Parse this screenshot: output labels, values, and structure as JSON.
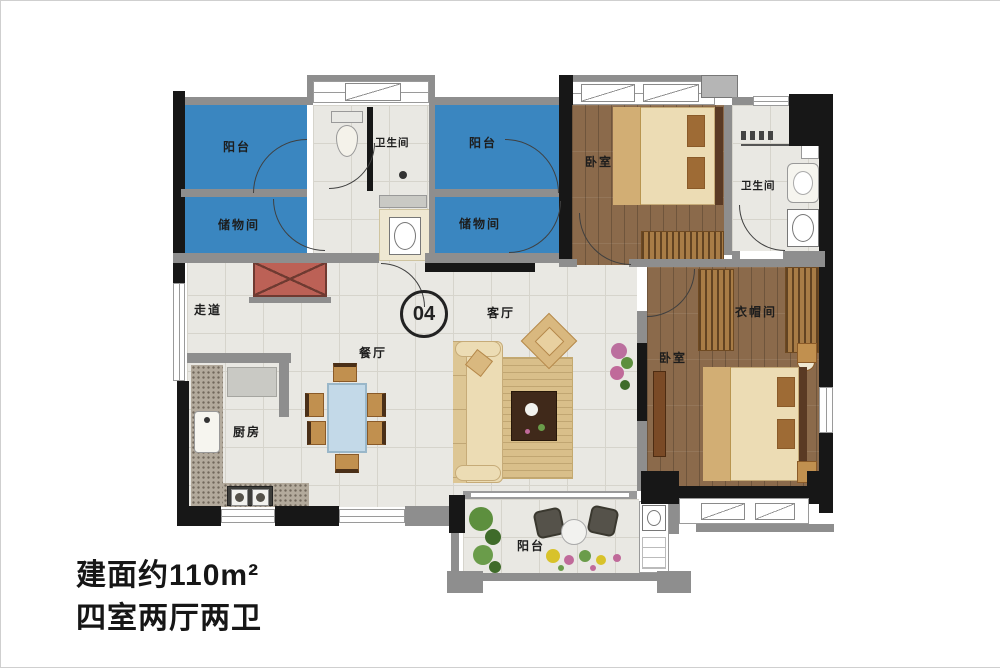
{
  "unit": {
    "number": "04"
  },
  "summary": {
    "area": "建面约110m²",
    "layout": "四室两厅两卫"
  },
  "rooms": {
    "balcony_nw": "阳台",
    "storage_w": "储物间",
    "bath_main": "卫生间",
    "balcony_n": "阳台",
    "storage_n": "储物间",
    "bedroom_ne": "卧室",
    "bath_ne": "卫生间",
    "corridor": "走道",
    "dining": "餐厅",
    "living": "客厅",
    "kitchen": "厨房",
    "cloakroom": "衣帽间",
    "bedroom_se": "卧室",
    "balcony_s": "阳台"
  },
  "furniture_icons": [
    "toilet",
    "washing-machine",
    "bed",
    "pillow",
    "wardrobe",
    "sofa",
    "rug",
    "coffee-table",
    "accent-chair",
    "dining-table",
    "dining-chair",
    "kitchen-counter",
    "sink",
    "stove",
    "shoe-cabinet",
    "tv-console",
    "nightstand",
    "balcony-chair",
    "balcony-table",
    "plant",
    "flower-bed"
  ],
  "colors": {
    "balcony_blue": "#3a86c0",
    "wall_gray": "#8e8e8e",
    "wall_black": "#171717",
    "tile_floor": "#e9e8e3",
    "wood_floor": "#8b6a4b",
    "cabinet_red": "#bc6156",
    "furniture_cream": "#ecdcb4",
    "furniture_tan": "#c1904f",
    "dining_table_blue": "#c3d9e8",
    "text_dark": "#1d1d1d"
  }
}
